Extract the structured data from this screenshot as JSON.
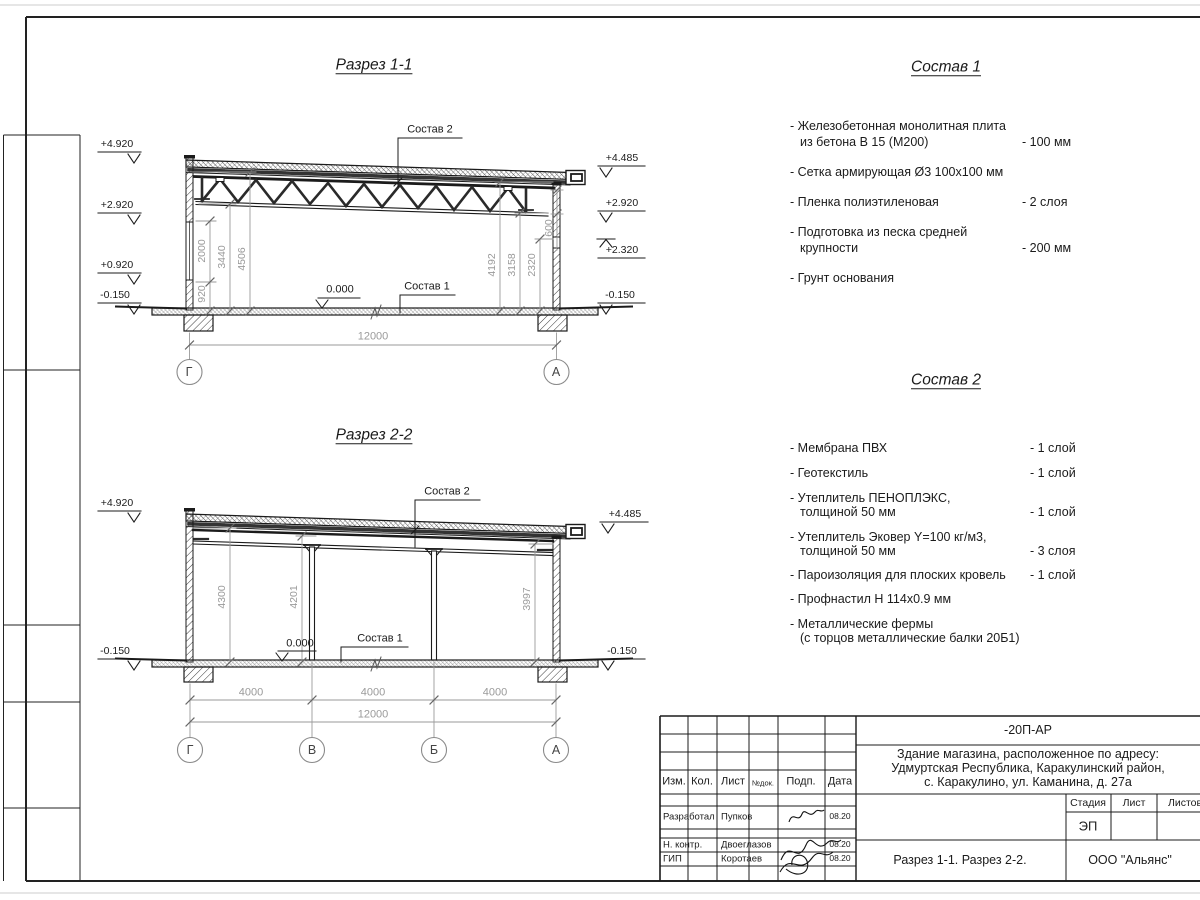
{
  "s11": {
    "title": "Разрез 1-1",
    "elev_left": [
      "+4.920",
      "+2.920",
      "+0.920",
      "-0.150"
    ],
    "elev_right": [
      "+4.485",
      "+2.920",
      "+2.320",
      "-0.150"
    ],
    "dims_left": [
      "920",
      "2000",
      "3440",
      "4506"
    ],
    "dims_right": [
      "4192",
      "3158",
      "2320",
      "600"
    ],
    "dim_total": "12000",
    "label_sostav2": "Состав 2",
    "label_sostav1": "Состав 1",
    "label_zero": "0.000",
    "grids": [
      "Г",
      "А"
    ]
  },
  "s22": {
    "title": "Разрез 2-2",
    "elev_left": [
      "+4.920",
      "-0.150"
    ],
    "elev_right": [
      "+4.485",
      "-0.150"
    ],
    "dims_vert": [
      "4300",
      "4201",
      "3997"
    ],
    "dims_bottom": [
      "4000",
      "4000",
      "4000"
    ],
    "dim_total": "12000",
    "label_sostav2": "Состав 2",
    "label_sostav1": "Состав 1",
    "label_zero": "0.000",
    "grids": [
      "Г",
      "В",
      "Б",
      "А"
    ]
  },
  "sostav1": {
    "title": "Состав 1",
    "items": [
      {
        "l1": "- Железобетонная  монолитная плита",
        "l2": "из бетона В 15 (М200)",
        "v": "- 100 мм"
      },
      {
        "l1": "- Сетка армирующая Ø3 100x100 мм"
      },
      {
        "l1": "- Пленка полиэтиленовая",
        "v": "-  2 слоя"
      },
      {
        "l1": "- Подготовка из песка средней",
        "l2": "крупности",
        "v": "- 200 мм"
      },
      {
        "l1": "- Грунт основания"
      }
    ]
  },
  "sostav2": {
    "title": "Состав 2",
    "items": [
      {
        "l1": "- Мембрана ПВХ",
        "v": "- 1 слой"
      },
      {
        "l1": "- Геотекстиль",
        "v": "- 1 слой"
      },
      {
        "l1": "- Утеплитель ПЕНОПЛЭКС,",
        "l2": "толщиной 50 мм",
        "v": "- 1 слой"
      },
      {
        "l1": "- Утеплитель Эковер Y=100 кг/м3,",
        "l2": "толщиной 50 мм",
        "v": "- 3 слоя"
      },
      {
        "l1": "- Пароизоляция для плоских кровель",
        "v": "- 1 слой"
      },
      {
        "l1": "- Профнастил Н 114х0.9 мм"
      },
      {
        "l1": "- Металлические фермы",
        "l2": "(с торцов металлические балки 20Б1)"
      }
    ]
  },
  "titleblock": {
    "doc_number": "-20П-АР",
    "address": [
      "Здание магазина, расположенное по адресу:",
      "Удмуртская Республика, Каракулинский район,",
      "с. Каракулино, ул. Каманина, д. 27а"
    ],
    "col_headers": [
      "Изм.",
      "Кол.",
      "Лист",
      "№док.",
      "Подп.",
      "Дата"
    ],
    "rows": [
      {
        "role": "Разработал",
        "name": "Пупков",
        "date": "08.20"
      },
      {
        "role": "Н. контр.",
        "name": "Двоеглазов",
        "date": "08.20"
      },
      {
        "role": "ГИП",
        "name": "Коротаев",
        "date": "08.20"
      }
    ],
    "stage_label": "Стадия",
    "sheet_label": "Лист",
    "sheets_label": "Листов",
    "stage_value": "ЭП",
    "sheet_title": "Разрез 1-1. Разрез 2-2.",
    "company": "ООО \"Альянс\""
  }
}
